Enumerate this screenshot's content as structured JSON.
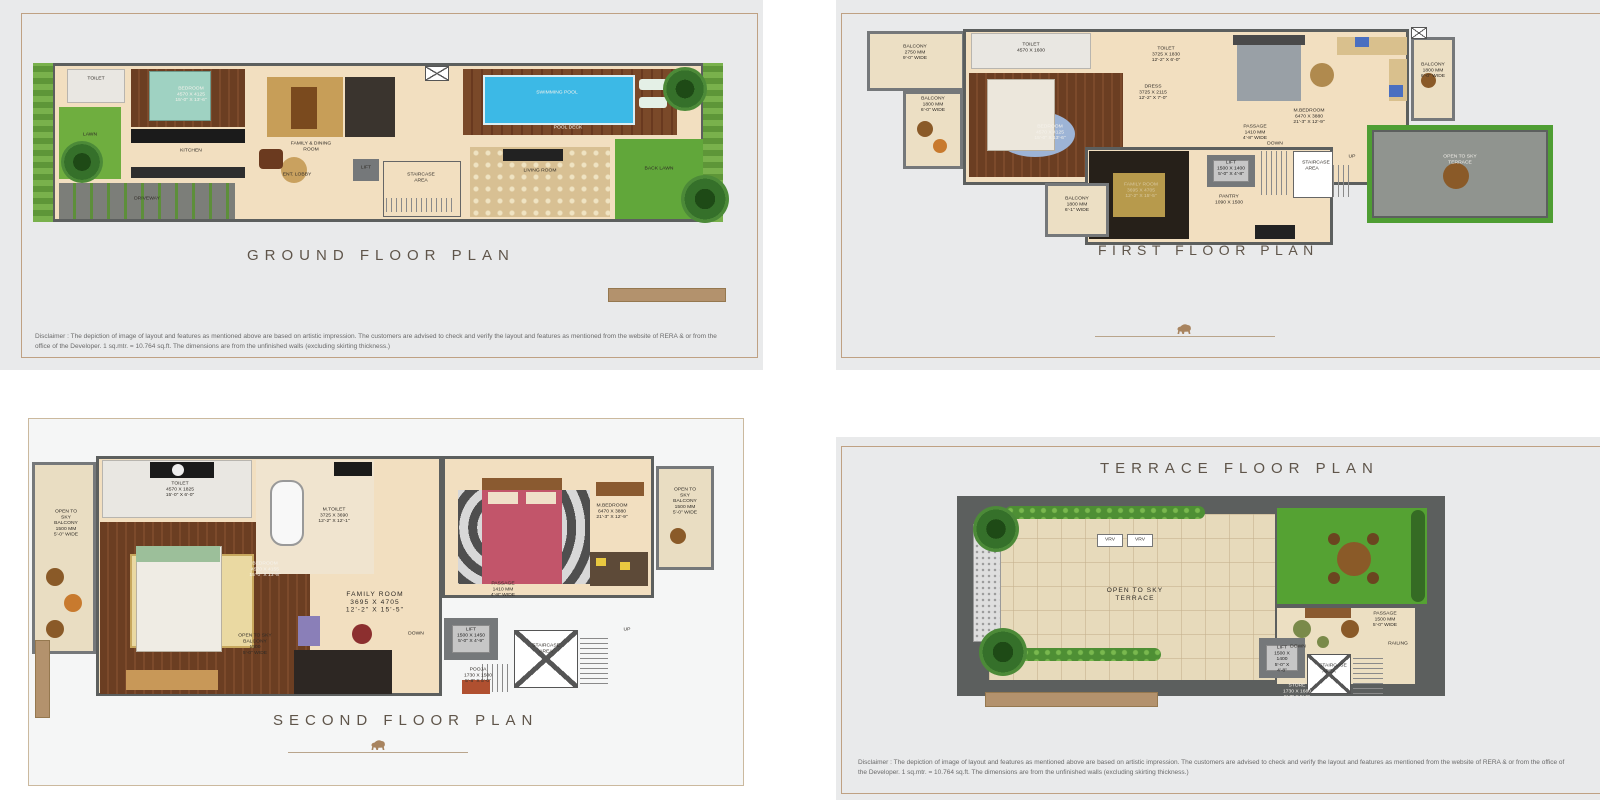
{
  "colors": {
    "accent_tan": "#b3926d",
    "panel_border": "#bfa183",
    "panel_bg": "#e9eaeb",
    "wall_grey": "#5c5f5e",
    "floor_beige": "#f2dfc0",
    "wood_brown": "#6b3e22",
    "lawn_green": "#6fae3f",
    "pool_blue": "#3cb9e6",
    "title_brown": "#5f554a"
  },
  "disclaimer": "Disclaimer : The depiction of image of layout and features as mentioned above are based on artistic impression. The customers are advised to check and verify the layout and features as mentioned from the website of RERA & or from the office of the Developer. 1 sq.mtr. = 10.764 sq.ft. The dimensions are from the unfinished walls (excluding skirting thickness.)",
  "panels": {
    "ground": {
      "title": "GROUND  FLOOR  PLAN",
      "rooms": {
        "lawn": "LAWN",
        "toilet": "TOILET",
        "bedroom": "BEDROOM\n4570 X 4125\n15'-0\" X 13'-6\"",
        "kitchen": "KITCHEN",
        "driveway": "DRIVEWAY",
        "family_dining": "FAMILY & DINING ROOM",
        "ent_lobby": "ENT. LOBBY",
        "lift": "LIFT",
        "staircase": "STAIRCASE\nAREA",
        "living": "LIVING ROOM",
        "pool": "SWIMMING POOL",
        "pool_deck": "POOL DECK",
        "back_lawn": "BACK LAWN"
      }
    },
    "first": {
      "title": "FIRST  FLOOR  PLAN",
      "rooms": {
        "balcony_top": "BALCONY\n2750 MM\n9'-0\" WIDE",
        "balcony_left": "BALCONY\n1800 MM\n6'-0\" WIDE",
        "toilet": "TOILET\n4570 X 1600",
        "bedroom": "BEDROOM\n4570 X 4125\n15'-0\" X 13'-6\"",
        "balcony_bottom": "BALCONY\n1800 MM\n6'-1\" WIDE",
        "toilet2": "TOILET\n3725 X 1830\n12'-2\" X 6'-0\"",
        "dress": "DRESS\n3725 X 2115\n12'-2\" X 7'-0\"",
        "family": "FAMILY ROOM\n3695 X 4705\n12'-2\" X 15'-5\"",
        "mbedroom": "M.BEDROOM\n6470 X 3880\n21'-3\" X 12'-9\"",
        "balcony_right": "BALCONY\n1800 MM\n6'-0\" WIDE",
        "passage": "PASSAGE\n1410 MM\n4'-8\" WIDE",
        "lift": "LIFT\n1500 X 1400\n5'-0\" X 4'-8\"",
        "staircase": "STAIRCASE\nAREA",
        "pantry": "PANTRY\n1090 X 1500",
        "terrace": "OPEN TO SKY\nTERRACE",
        "down": "DOWN",
        "up": "UP"
      }
    },
    "second": {
      "title": "SECOND  FLOOR  PLAN",
      "rooms": {
        "balcony_left": "OPEN TO SKY\nBALCONY\n1500 MM\n5'-0\" WIDE",
        "toilet": "TOILET\n4570 X 1825\n15'-0\" X 6'-0\"",
        "bedroom": "BEDROOM\n4570 X 4155\n15'-0\" X 13'-8\"",
        "mtoilet": "M.TOILET\n3725 X 3690\n12'-2\" X 12'-1\"",
        "mbedroom": "M.BEDROOM\n6470 X 3880\n21'-3\" X 12'-9\"",
        "balcony_right": "OPEN TO SKY\nBALCONY\n1500 MM\n5'-0\" WIDE",
        "family": "FAMILY ROOM\n3695 X 4705\n12'-2\" X 15'-5\"",
        "passage": "PASSAGE\n1410 MM\n4'-8\" WIDE",
        "lift": "LIFT\n1500 X 1450\n5'-0\" X 4'-9\"",
        "pooja": "POOJA\n1730 X 1500\n5'-8\" X 5'-0\"",
        "staircase": "STAIRCASE\nAREA",
        "balcony_bottom": "OPEN TO SKY\nBALCONY\n1500\n5'-0\" WIDE",
        "down": "DOWN",
        "up": "UP"
      }
    },
    "terrace": {
      "title": "TERRACE  FLOOR  PLAN",
      "rooms": {
        "vrv": "VRV",
        "open_terrace": "OPEN TO SKY\nTERRACE",
        "passage": "PASSAGE\n1500 MM\n5'-0\" WIDE",
        "lift": "LIFT\n1500 X 1400\n5'-0\" X 4'-8\"",
        "staircase": "STAIRCASE\nAREA",
        "store": "STORE\n1730 X 1680\n5'-8\" X 5'-6\"",
        "down": "DOWN",
        "railing": "RAILING"
      }
    }
  }
}
